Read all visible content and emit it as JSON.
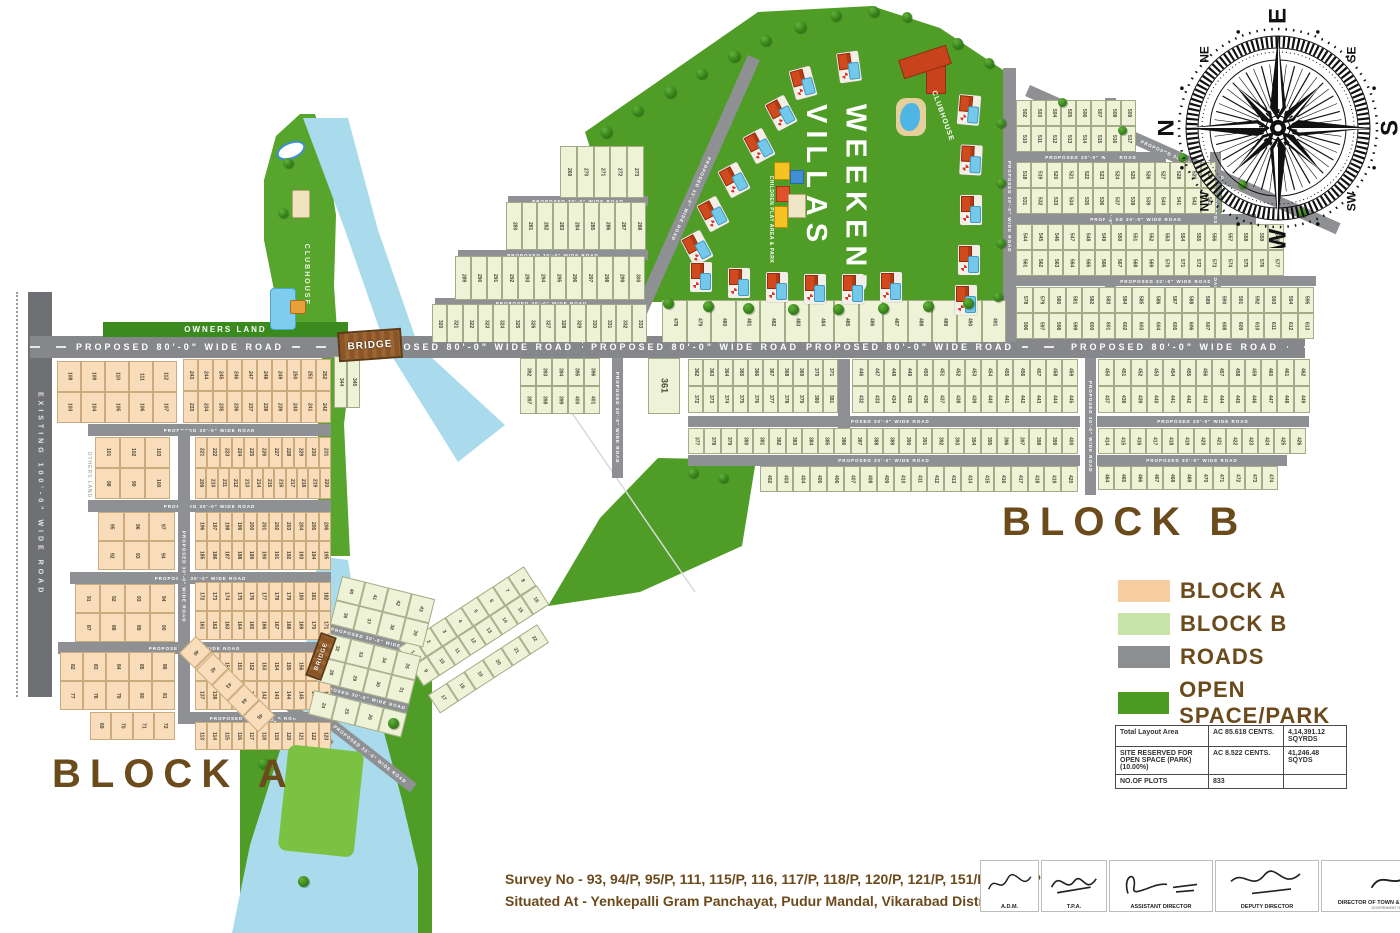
{
  "labels": {
    "block_a": "BLOCK A",
    "block_b": "BLOCK B",
    "weekend_villas": "WEEKEND\nVILLAS",
    "clubhouse": "CLUBHOUSE",
    "clubhouse_island": "CLUBHOUSE",
    "children_play": "CHILDREN PLAY AREA & PARK",
    "owners_land": "OWNERS LAND",
    "others_land": "OTHERS LAND",
    "bridge": "BRIDGE",
    "existing_road": "EXISTING  100'-0\" WIDE ROAD",
    "road80": "PROPOSED   80'-0\"   WIDE   ROAD",
    "road30": "PROPOSED 30'-0\" WIDE ROAD",
    "road33": "PROPOSED 33'-0\" WIDE ROAD"
  },
  "compass": {
    "cardinals": [
      "N",
      "E",
      "S",
      "W"
    ],
    "intercardinals": [
      "NE",
      "SE",
      "SW",
      "NW"
    ]
  },
  "legend": {
    "items": [
      {
        "label": "BLOCK A",
        "color": "#f6cda1"
      },
      {
        "label": "BLOCK B",
        "color": "#c6e3a8"
      },
      {
        "label": "ROADS",
        "color": "#8c8e90"
      },
      {
        "label": "OPEN SPACE/PARK",
        "color": "#4d9a20"
      }
    ]
  },
  "summary_table": {
    "rows": [
      [
        "Total Layout Area",
        "AC 85.618 CENTS.",
        "4,14,391.12 SQYRDS"
      ],
      [
        "SITE RESERVED FOR OPEN SPACE (PARK)(10.00%)",
        "AC 8.522 CENTS.",
        "41,246.48 SQYDS"
      ],
      [
        "NO.OF PLOTS",
        "833",
        ""
      ]
    ]
  },
  "survey": {
    "line1": "Survey No - 93, 94/P, 95/P, 111, 115/P, 116, 117/P, 118/P, 120/P, 121/P, 151/P & 152/P/",
    "line2": "Situated At - Yenkepalli Gram Panchayat, Pudur Mandal, Vikarabad District."
  },
  "signatures": [
    {
      "label": "A.D.M.",
      "sub": ""
    },
    {
      "label": "T.P.A.",
      "sub": ""
    },
    {
      "label": "ASSISTANT DIRECTOR",
      "sub": ""
    },
    {
      "label": "DEPUTY DIRECTOR",
      "sub": ""
    },
    {
      "label": "DIRECTOR OF TOWN & COUNTRY PLANNING",
      "sub": "GOVERNMENT OF TELANGANA"
    }
  ],
  "map": {
    "colors": {
      "water": "#a9dbec",
      "park": "#4f9d26",
      "park_light": "#7cc242",
      "road": "#8e9093",
      "block_a_fill": "#f9dcba",
      "block_b_fill": "#eef3d8"
    },
    "plot_bands": [
      {
        "b": "A",
        "x": 57,
        "y": 361,
        "w": 120,
        "h": 31,
        "n": 5,
        "s": 108
      },
      {
        "b": "A",
        "x": 57,
        "y": 392,
        "w": 120,
        "h": 31,
        "n": 5,
        "s": 103
      },
      {
        "b": "A",
        "x": 183,
        "y": 359,
        "w": 148,
        "h": 32,
        "n": 10,
        "s": 243
      },
      {
        "b": "A",
        "x": 183,
        "y": 391,
        "w": 148,
        "h": 32,
        "n": 10,
        "s": 233
      },
      {
        "b": "A",
        "x": 95,
        "y": 437,
        "w": 75,
        "h": 31,
        "n": 3,
        "s": 101
      },
      {
        "b": "A",
        "x": 95,
        "y": 468,
        "w": 75,
        "h": 31,
        "n": 3,
        "s": 98
      },
      {
        "b": "A",
        "x": 195,
        "y": 437,
        "w": 136,
        "h": 31,
        "n": 11,
        "s": 221
      },
      {
        "b": "A",
        "x": 195,
        "y": 468,
        "w": 136,
        "h": 31,
        "n": 12,
        "s": 209
      },
      {
        "b": "A",
        "x": 98,
        "y": 512,
        "w": 77,
        "h": 29,
        "n": 3,
        "s": 95
      },
      {
        "b": "A",
        "x": 98,
        "y": 541,
        "w": 77,
        "h": 29,
        "n": 3,
        "s": 92
      },
      {
        "b": "A",
        "x": 195,
        "y": 512,
        "w": 136,
        "h": 29,
        "n": 11,
        "s": 196
      },
      {
        "b": "A",
        "x": 195,
        "y": 541,
        "w": 136,
        "h": 29,
        "n": 11,
        "s": 185
      },
      {
        "b": "A",
        "x": 75,
        "y": 584,
        "w": 100,
        "h": 29,
        "n": 4,
        "s": 91
      },
      {
        "b": "A",
        "x": 75,
        "y": 613,
        "w": 100,
        "h": 29,
        "n": 4,
        "s": 87
      },
      {
        "b": "A",
        "x": 195,
        "y": 582,
        "w": 136,
        "h": 29,
        "n": 11,
        "s": 172
      },
      {
        "b": "A",
        "x": 195,
        "y": 611,
        "w": 136,
        "h": 29,
        "n": 11,
        "s": 161
      },
      {
        "b": "A",
        "x": 60,
        "y": 652,
        "w": 115,
        "h": 29,
        "n": 5,
        "s": 82
      },
      {
        "b": "A",
        "x": 60,
        "y": 681,
        "w": 115,
        "h": 29,
        "n": 5,
        "s": 77
      },
      {
        "b": "A",
        "x": 195,
        "y": 652,
        "w": 136,
        "h": 29,
        "n": 11,
        "s": 148
      },
      {
        "b": "A",
        "x": 195,
        "y": 681,
        "w": 136,
        "h": 29,
        "n": 11,
        "s": 137
      },
      {
        "b": "A",
        "x": 195,
        "y": 722,
        "w": 136,
        "h": 28,
        "n": 11,
        "s": 113
      },
      {
        "b": "A",
        "x": 90,
        "y": 712,
        "w": 85,
        "h": 28,
        "n": 4,
        "s": 69
      },
      {
        "b": "A",
        "x": 196,
        "y": 636,
        "w": 88,
        "h": 24,
        "n": 4,
        "s": 46,
        "r": 45
      },
      {
        "b": "A",
        "x": 213,
        "y": 653,
        "w": 88,
        "h": 24,
        "n": 4,
        "s": 42,
        "r": 45
      },
      {
        "b": "B",
        "x": 560,
        "y": 146,
        "w": 84,
        "h": 52,
        "n": 5,
        "s": 269
      },
      {
        "b": "B",
        "x": 506,
        "y": 202,
        "w": 140,
        "h": 48,
        "n": 9,
        "s": 280
      },
      {
        "b": "B",
        "x": 455,
        "y": 256,
        "w": 190,
        "h": 44,
        "n": 12,
        "s": 289
      },
      {
        "b": "B",
        "x": 432,
        "y": 304,
        "w": 215,
        "h": 40,
        "n": 14,
        "s": 320
      },
      {
        "b": "B",
        "x": 334,
        "y": 356,
        "w": 26,
        "h": 52,
        "n": 2,
        "s": 344
      },
      {
        "b": "B",
        "x": 662,
        "y": 300,
        "w": 344,
        "h": 44,
        "n": 14,
        "s": 478
      },
      {
        "b": "B",
        "x": 1016,
        "y": 100,
        "w": 120,
        "h": 26,
        "n": 8,
        "s": 502
      },
      {
        "b": "B",
        "x": 1016,
        "y": 126,
        "w": 120,
        "h": 26,
        "n": 8,
        "s": 510
      },
      {
        "b": "B",
        "x": 1016,
        "y": 162,
        "w": 200,
        "h": 26,
        "n": 13,
        "s": 518
      },
      {
        "b": "B",
        "x": 1016,
        "y": 188,
        "w": 200,
        "h": 26,
        "n": 13,
        "s": 531
      },
      {
        "b": "B",
        "x": 1016,
        "y": 224,
        "w": 268,
        "h": 26,
        "n": 17,
        "s": 544
      },
      {
        "b": "B",
        "x": 1016,
        "y": 250,
        "w": 268,
        "h": 26,
        "n": 17,
        "s": 561
      },
      {
        "b": "B",
        "x": 1016,
        "y": 287,
        "w": 298,
        "h": 26,
        "n": 18,
        "s": 578
      },
      {
        "b": "B",
        "x": 1016,
        "y": 313,
        "w": 298,
        "h": 26,
        "n": 18,
        "s": 596
      },
      {
        "b": "B",
        "x": 648,
        "y": 358,
        "w": 32,
        "h": 56,
        "n": 1,
        "s": 361
      },
      {
        "b": "B",
        "x": 520,
        "y": 358,
        "w": 80,
        "h": 28,
        "n": 5,
        "s": 392
      },
      {
        "b": "B",
        "x": 520,
        "y": 386,
        "w": 80,
        "h": 28,
        "n": 5,
        "s": 397
      },
      {
        "b": "B",
        "x": 688,
        "y": 359,
        "w": 150,
        "h": 27,
        "n": 10,
        "s": 362
      },
      {
        "b": "B",
        "x": 688,
        "y": 386,
        "w": 150,
        "h": 27,
        "n": 10,
        "s": 372
      },
      {
        "b": "B",
        "x": 852,
        "y": 359,
        "w": 226,
        "h": 27,
        "n": 14,
        "s": 446
      },
      {
        "b": "B",
        "x": 852,
        "y": 386,
        "w": 226,
        "h": 27,
        "n": 14,
        "s": 432
      },
      {
        "b": "B",
        "x": 688,
        "y": 428,
        "w": 390,
        "h": 26,
        "n": 24,
        "s": 377
      },
      {
        "b": "B",
        "x": 760,
        "y": 466,
        "w": 318,
        "h": 26,
        "n": 19,
        "s": 402
      },
      {
        "b": "B",
        "x": 1098,
        "y": 359,
        "w": 212,
        "h": 27,
        "n": 13,
        "s": 450
      },
      {
        "b": "B",
        "x": 1098,
        "y": 386,
        "w": 212,
        "h": 27,
        "n": 13,
        "s": 437
      },
      {
        "b": "B",
        "x": 1098,
        "y": 428,
        "w": 208,
        "h": 26,
        "n": 13,
        "s": 414
      },
      {
        "b": "B",
        "x": 1098,
        "y": 466,
        "w": 180,
        "h": 24,
        "n": 11,
        "s": 464
      },
      {
        "b": "B",
        "x": 398,
        "y": 648,
        "w": 150,
        "h": 23,
        "n": 8,
        "s": 1,
        "r": -33
      },
      {
        "b": "B",
        "x": 411,
        "y": 667,
        "w": 150,
        "h": 23,
        "n": 8,
        "s": 9,
        "r": -33
      },
      {
        "b": "B",
        "x": 428,
        "y": 695,
        "w": 130,
        "h": 22,
        "n": 6,
        "s": 17,
        "r": -33
      },
      {
        "b": "B",
        "x": 342,
        "y": 576,
        "w": 96,
        "h": 25,
        "n": 4,
        "s": 40,
        "r": 14
      },
      {
        "b": "B",
        "x": 336,
        "y": 600,
        "w": 96,
        "h": 25,
        "n": 4,
        "s": 36,
        "r": 14
      },
      {
        "b": "B",
        "x": 328,
        "y": 633,
        "w": 96,
        "h": 25,
        "n": 4,
        "s": 32,
        "r": 14
      },
      {
        "b": "B",
        "x": 322,
        "y": 657,
        "w": 96,
        "h": 25,
        "n": 4,
        "s": 28,
        "r": 14
      },
      {
        "b": "B",
        "x": 314,
        "y": 690,
        "w": 96,
        "h": 25,
        "n": 4,
        "s": 24,
        "r": 14
      }
    ],
    "main_road_label_centers": [
      180,
      470,
      695,
      910,
      1175
    ]
  }
}
